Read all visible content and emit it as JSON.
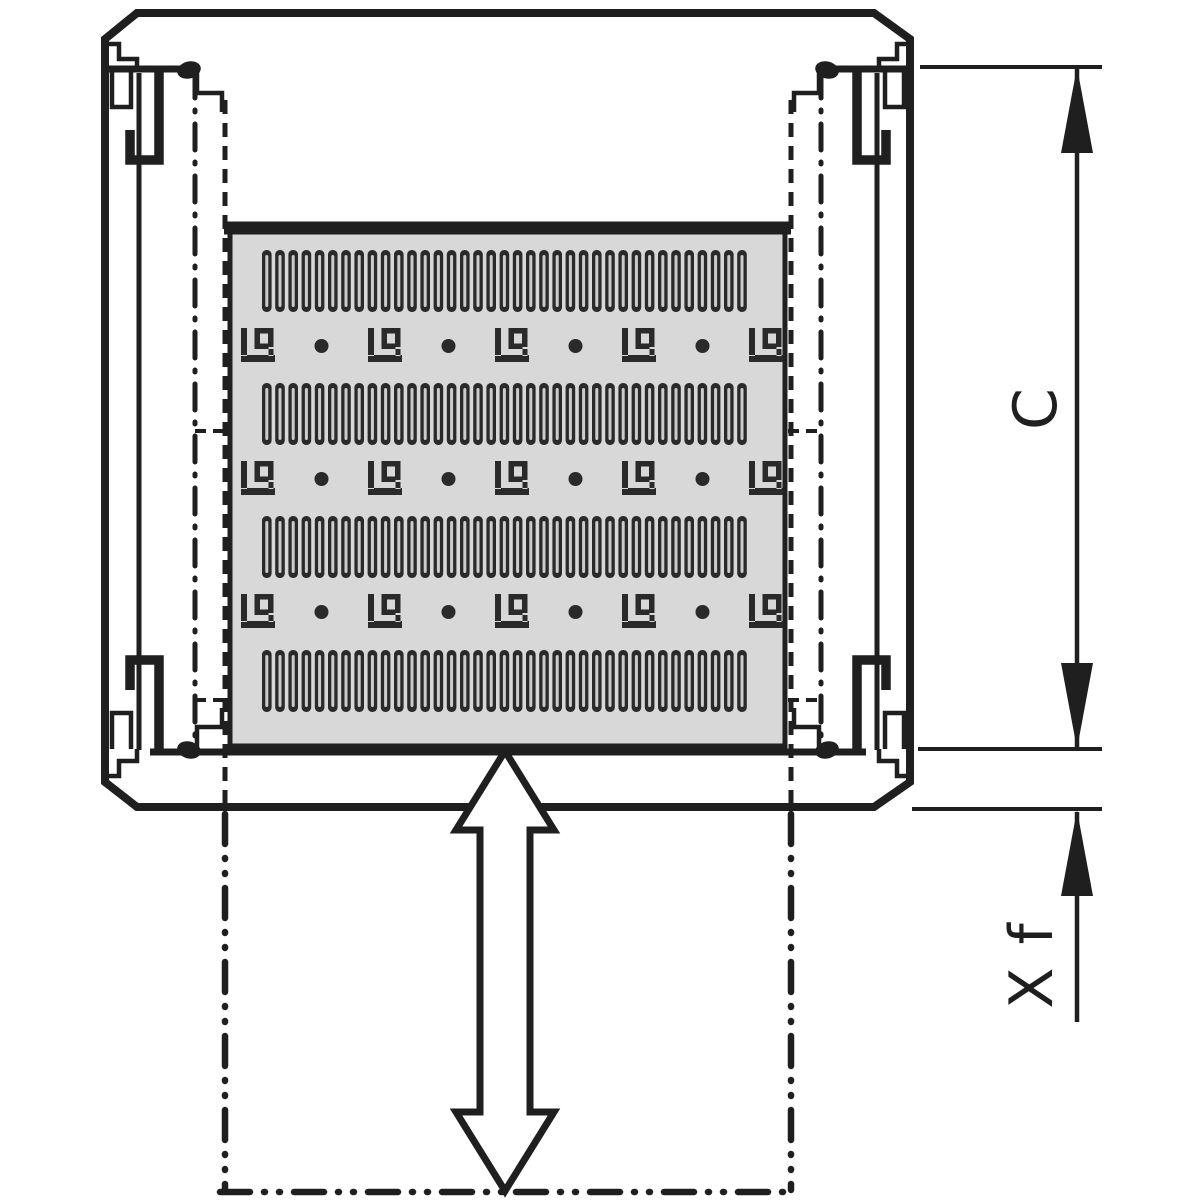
{
  "diagram": {
    "kind": "technical-drawing",
    "dimension_labels": {
      "height": "C",
      "extension": "X f"
    }
  },
  "panel": {
    "slot_bands": 4,
    "slots_per_band": 37,
    "bracket_rows": 3,
    "brackets_per_row": 5,
    "dots_per_row": 4
  },
  "colors": {
    "ink": "#1f1f1f",
    "panel_fill": "#d8d8d8",
    "slot": "#2a2a2a",
    "slot_slit": "#cccccc",
    "background": "#ffffff"
  }
}
